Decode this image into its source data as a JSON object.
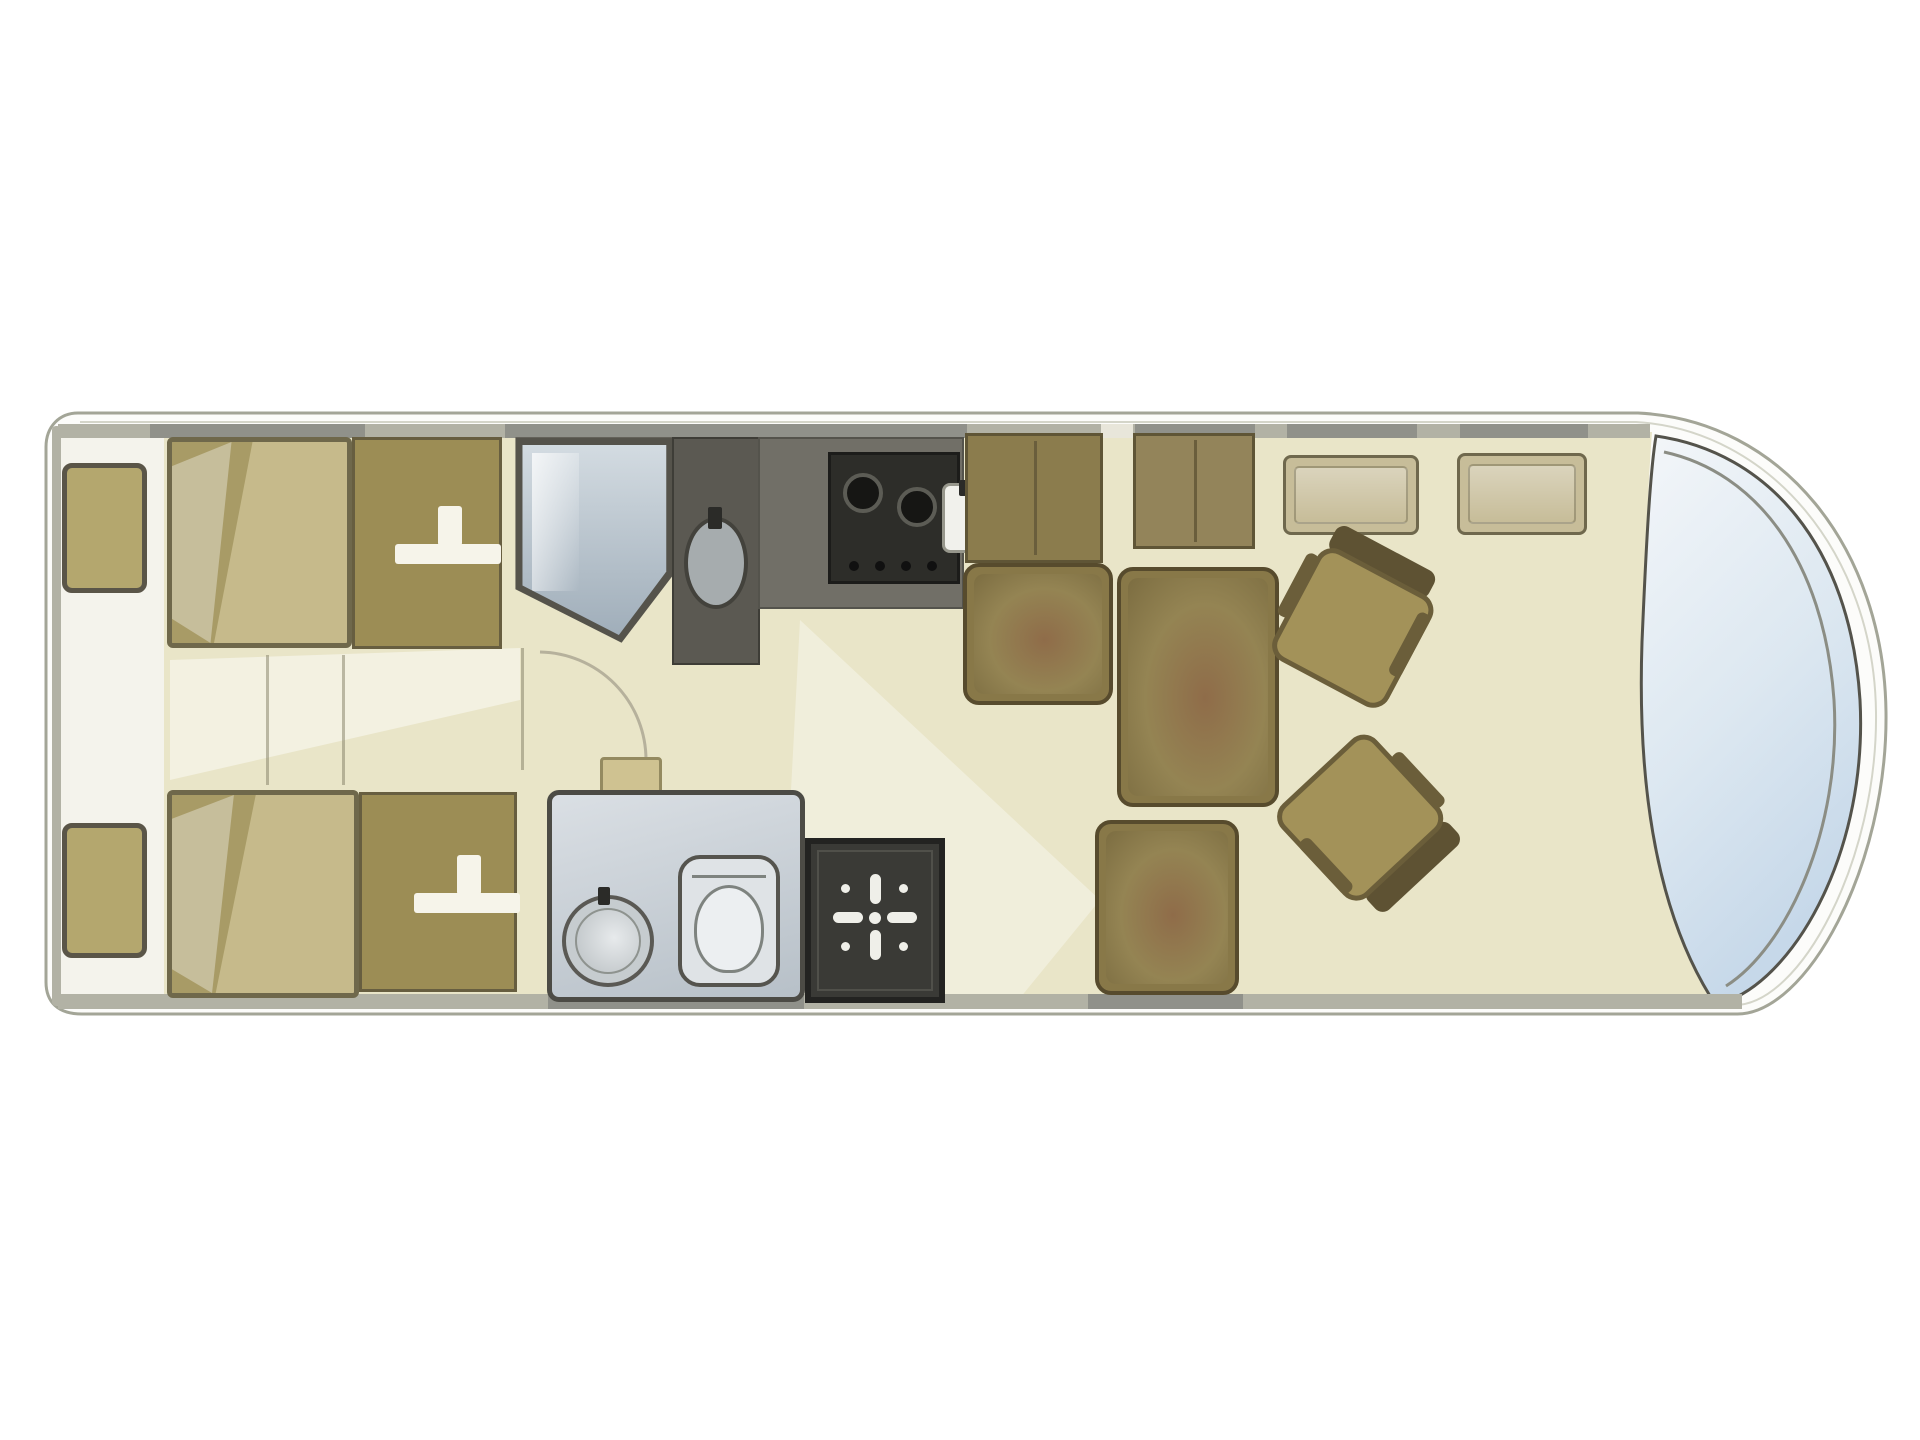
{
  "diagram": {
    "type": "motorhome-floorplan",
    "view": "top-down",
    "orientation": "front-of-vehicle-right, rear-left",
    "rooms": [
      {
        "name": "rear-bedroom",
        "features": [
          "twin-single-beds",
          "two-bedside-cabinets",
          "two-wardrobes-with-hanger-icons",
          "central-aisle"
        ]
      },
      {
        "name": "washroom-offside",
        "features": [
          "corner-glass-shower-cubicle",
          "vanity-unit-with-oval-basin"
        ]
      },
      {
        "name": "washroom-nearside",
        "features": [
          "round-washbasin",
          "toilet",
          "dark-shower-tray-with-drain-rose"
        ]
      },
      {
        "name": "kitchen",
        "features": [
          "hob-with-two-burners",
          "worktop",
          "small-sink",
          "tall-cabinet"
        ]
      },
      {
        "name": "front-lounge",
        "features": [
          "side-bench-seat",
          "centre-table",
          "front-bench-seat",
          "two-swivel-cab-seats",
          "overhead-lockers"
        ]
      },
      {
        "name": "cab",
        "features": [
          "wraparound-windscreen"
        ]
      }
    ],
    "icons": [
      {
        "name": "hanger-icon",
        "meaning": "wardrobe clothes hanger",
        "glyph": "white T-bar"
      },
      {
        "name": "burner-icon",
        "meaning": "gas hob burner",
        "glyph": "dark circle with grey ring"
      },
      {
        "name": "drain-rose-icon",
        "meaning": "shower head / drain",
        "glyph": "white four-petal star"
      }
    ]
  },
  "colors": {
    "body-outline": "#a3a597",
    "body-fill": "#fcfcfa",
    "floor": "#e9e5c8",
    "rear-panel": "#f4f3ec",
    "wall": "#b2b2a5",
    "window-seg": "#90918a",
    "bed-fill": "#c6ba8b",
    "bed-border": "#6f684b",
    "bed-fold": "#a89b66",
    "bedside-fill": "#b4a76e",
    "bedside-border": "#5a5548",
    "wardrobe-fill": "#9c8d55",
    "wardrobe-border": "#675e40",
    "shower-frame": "#55534b",
    "shower-glass1": "#d4dce2",
    "shower-glass2": "#9fadb9",
    "washunit": "#5b5952",
    "basin": "#a6acae",
    "kitchen": "#716f67",
    "stove": "#2d2d29",
    "burner": "#161614",
    "cabinet": "#8b7c4d",
    "locker": "#c7bd99",
    "seat": "#887848",
    "seat-border": "#574b2d",
    "seat-pad": "#948453",
    "seat-blotch": "#8f6c49",
    "cabseat-cushion": "#a39259",
    "cabseat-border": "#6b5e3a",
    "cabseat-back": "#5e5233",
    "washroom1": "#dadfe4",
    "washroom2": "#b7c0c8",
    "showertray": "#3a3a36",
    "windscreen1": "#f3f6f9",
    "windscreen2": "#c6d8e9"
  }
}
